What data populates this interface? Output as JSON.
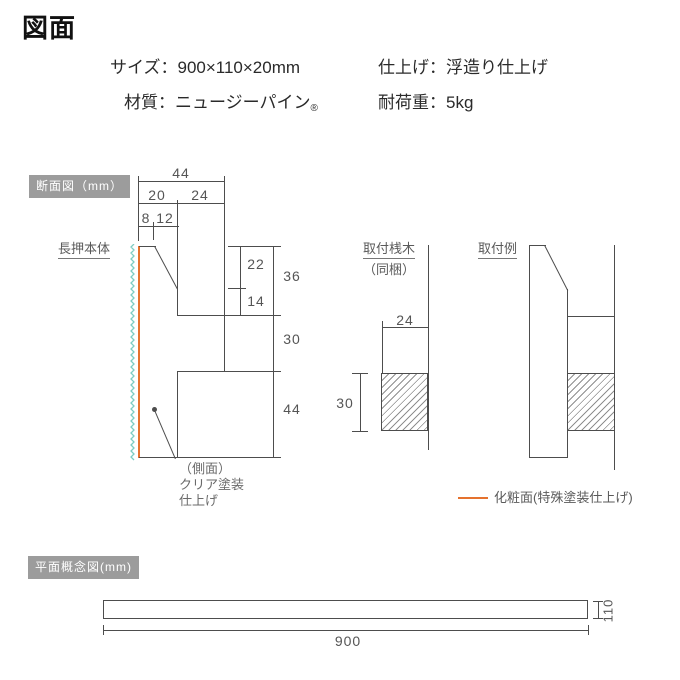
{
  "page": {
    "title": "図面"
  },
  "specs": {
    "size": "サイズ：900×110×20mm",
    "finish": "仕上げ：浮造り仕上げ",
    "material": "材質：ニュージーパイン",
    "material_mark": "®",
    "load": "耐荷重：5kg"
  },
  "section_view": {
    "badge": "断面図（mm）",
    "body_label": "長押本体",
    "side_finish_note": [
      "（側面）",
      "クリア塗装",
      "仕上げ"
    ],
    "dims": {
      "total_depth": "44",
      "front_depth": "20",
      "rear_depth": "24",
      "top_flat": "8",
      "slope": "12",
      "upper": "22",
      "hook_gap": "14",
      "upper_total": "36",
      "hook": "30",
      "lower": "44"
    }
  },
  "batten_view": {
    "label": "取付桟木",
    "sublabel": "（同梱）",
    "dims": {
      "depth": "24",
      "height": "30"
    }
  },
  "install_view": {
    "label": "取付例"
  },
  "legend": {
    "decorative_face": "化粧面(特殊塗装仕上げ)"
  },
  "plan_view": {
    "badge": "平面概念図(mm)",
    "dims": {
      "length": "900",
      "height": "110"
    }
  },
  "colors": {
    "decorative_face_orange": "#e5722e",
    "wall_break_teal": "#7ecdc3",
    "line_gray": "#4d4d4d",
    "badge_gray": "#9c9c9c"
  }
}
